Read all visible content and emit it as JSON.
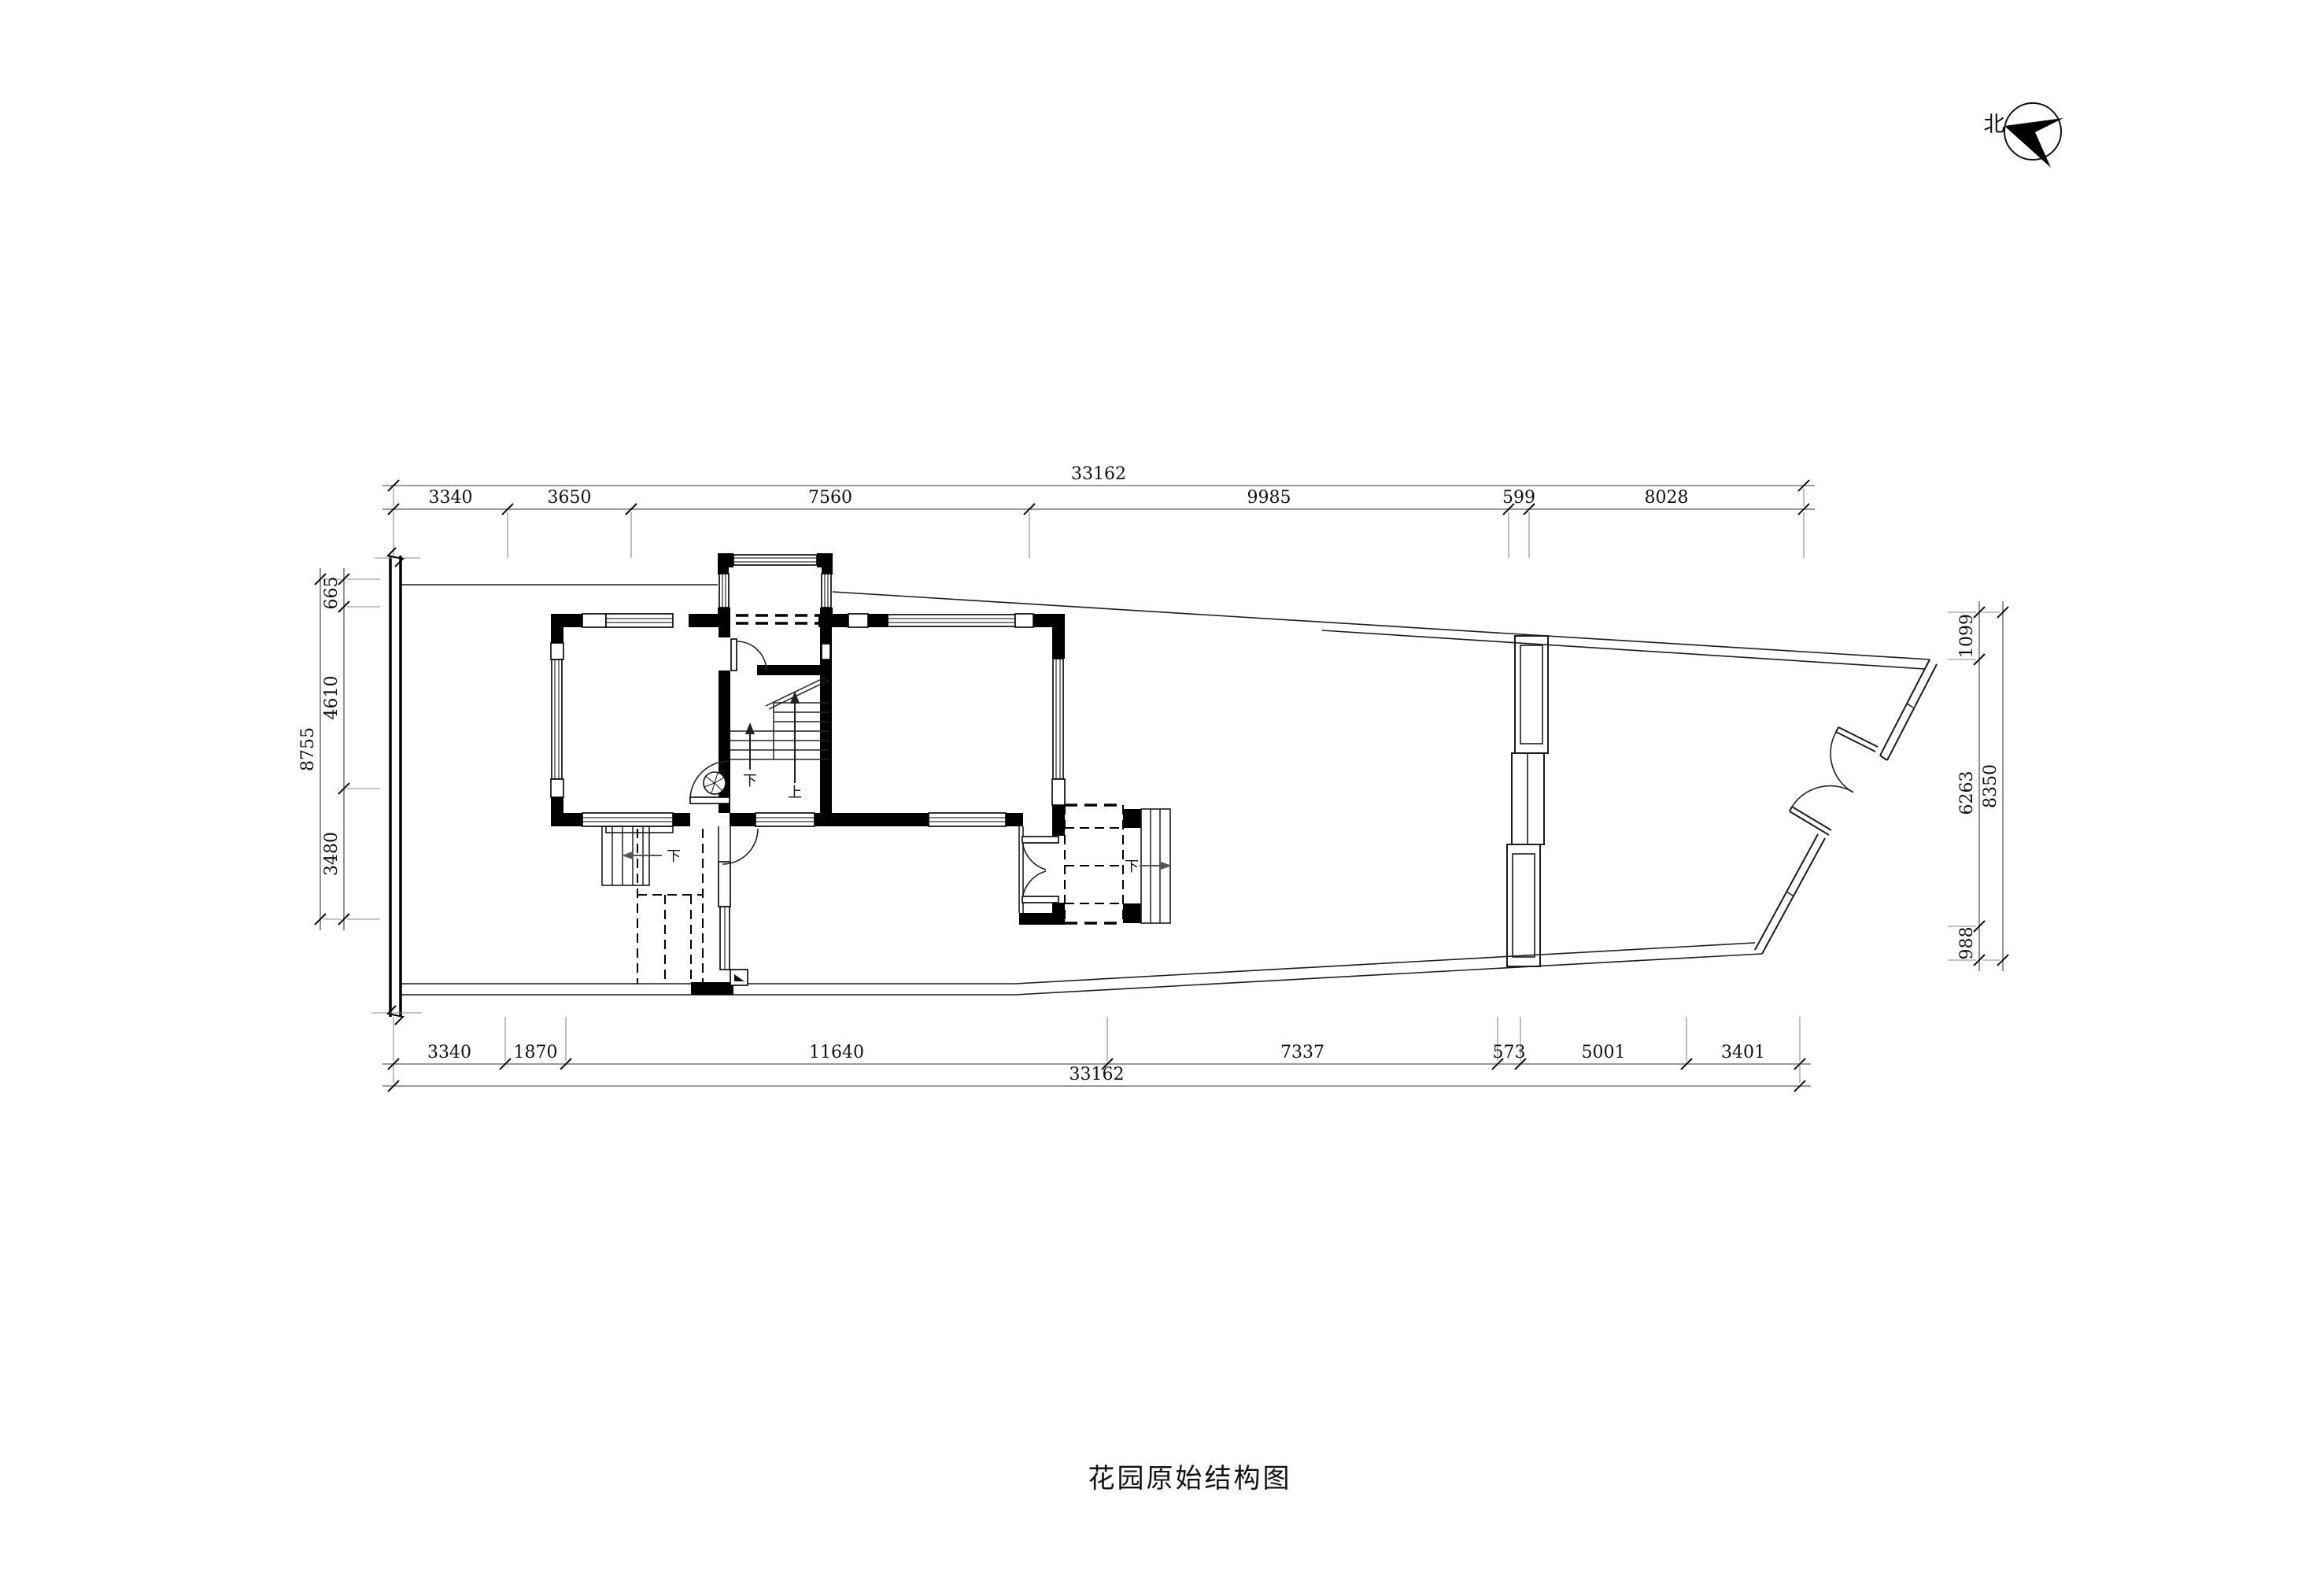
{
  "meta": {
    "title": "花园原始结构图",
    "north": "北"
  },
  "dimensions": {
    "top": {
      "total": "33162",
      "segments": [
        "3340",
        "3650",
        "7560",
        "9985",
        "599",
        "8028"
      ]
    },
    "bottom": {
      "total": "33162",
      "segments": [
        "3340",
        "1870",
        "11640",
        "7337",
        "573",
        "5001",
        "3401"
      ]
    },
    "left": {
      "total": "8755",
      "segments": [
        "665",
        "4610",
        "3480"
      ]
    },
    "right": {
      "total": "8350",
      "segments": [
        "1099",
        "6263",
        "988"
      ]
    }
  },
  "plan_labels": {
    "up": "上",
    "down": "下"
  }
}
